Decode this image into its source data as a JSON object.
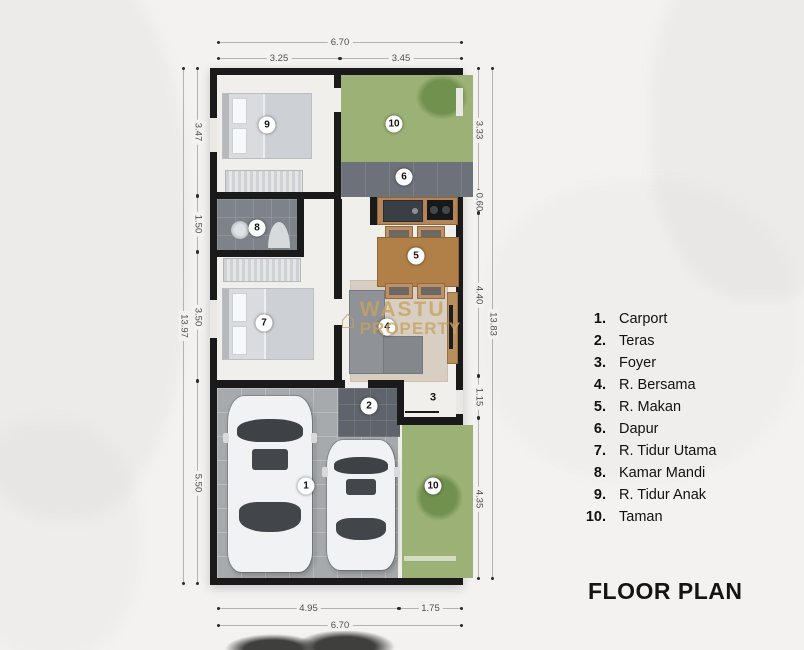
{
  "title": "FLOOR PLAN",
  "watermark": {
    "house_icon": "⌂",
    "line1": "WASTU",
    "line2": "PROPERTY"
  },
  "legend": {
    "items": [
      {
        "num": "1.",
        "label": "Carport"
      },
      {
        "num": "2.",
        "label": "Teras"
      },
      {
        "num": "3.",
        "label": "Foyer"
      },
      {
        "num": "4.",
        "label": "R. Bersama"
      },
      {
        "num": "5.",
        "label": "R. Makan"
      },
      {
        "num": "6.",
        "label": "Dapur"
      },
      {
        "num": "7.",
        "label": "R. Tidur Utama"
      },
      {
        "num": "8.",
        "label": "Kamar Mandi"
      },
      {
        "num": "9.",
        "label": "R. Tidur Anak"
      },
      {
        "num": "10.",
        "label": "Taman"
      }
    ]
  },
  "dimensions": {
    "top": {
      "total": "6.70",
      "segments": [
        "3.25",
        "3.45"
      ]
    },
    "bottom": {
      "total": "6.70",
      "segments": [
        "4.95",
        "1.75"
      ]
    },
    "left": {
      "total": "13.97",
      "segments": [
        "3.47",
        "1.50",
        "3.50",
        "5.50"
      ]
    },
    "right": {
      "total": "13.83",
      "segments": [
        "3.33",
        "0.60",
        "4.40",
        "1.15",
        "4.35"
      ]
    }
  },
  "markers": [
    {
      "label": "9",
      "x": 267,
      "y": 125,
      "circled": true
    },
    {
      "label": "10",
      "x": 394,
      "y": 124,
      "circled": true
    },
    {
      "label": "6",
      "x": 404,
      "y": 177,
      "circled": true
    },
    {
      "label": "8",
      "x": 257,
      "y": 228,
      "circled": true
    },
    {
      "label": "5",
      "x": 416,
      "y": 256,
      "circled": true
    },
    {
      "label": "7",
      "x": 264,
      "y": 323,
      "circled": true
    },
    {
      "label": "4",
      "x": 387,
      "y": 327,
      "circled": true
    },
    {
      "label": "2",
      "x": 369,
      "y": 406,
      "circled": true
    },
    {
      "label": "3",
      "x": 433,
      "y": 397,
      "circled": false
    },
    {
      "label": "1",
      "x": 306,
      "y": 486,
      "circled": true
    },
    {
      "label": "10",
      "x": 433,
      "y": 486,
      "circled": true
    }
  ],
  "colors": {
    "wall": "#1a1a1a",
    "floor": "#f0efec",
    "grass": "#9cb175",
    "wood": "#b5855a",
    "watermark_gold": "#c6a161",
    "legend_text": "#111111"
  }
}
